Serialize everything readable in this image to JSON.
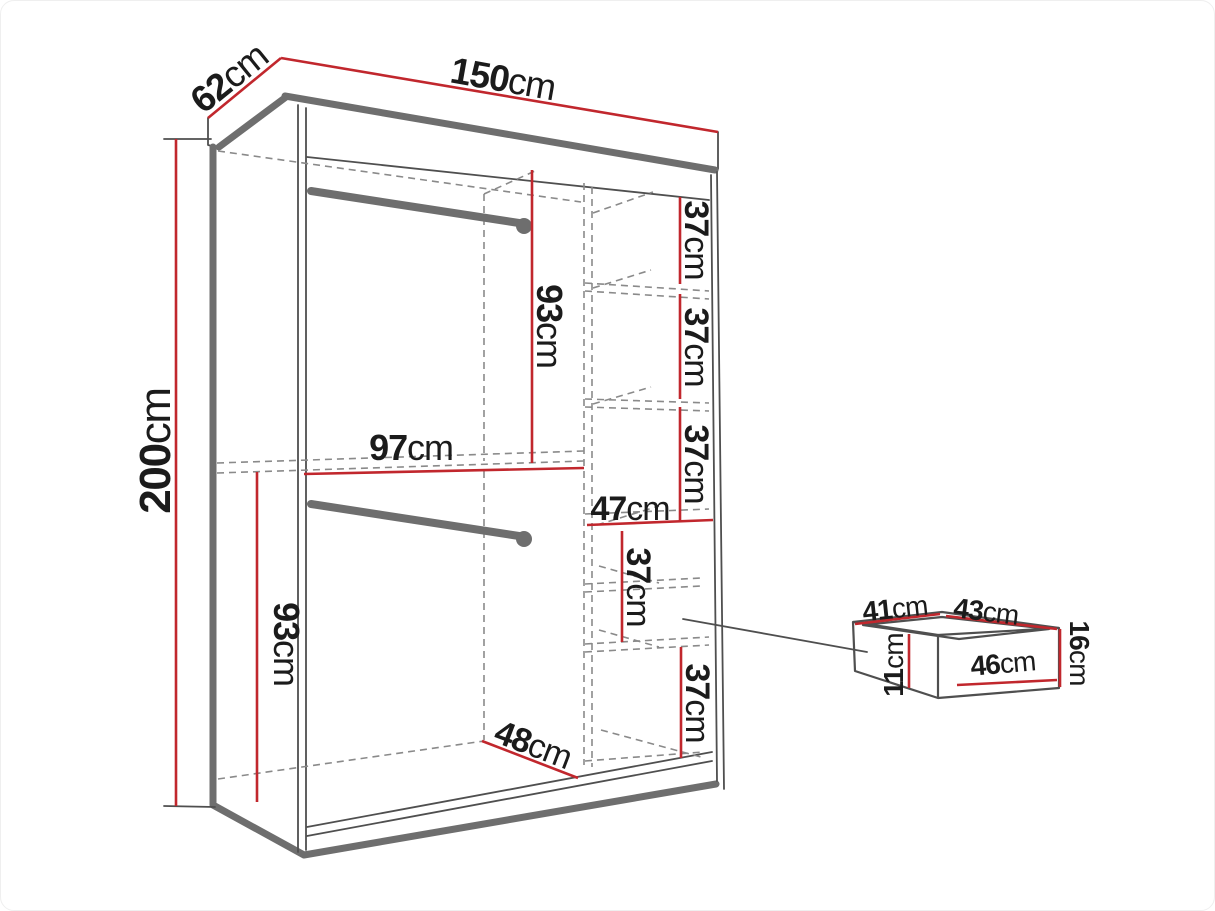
{
  "figure": {
    "type": "furniture-dimension-diagram",
    "subject": "sliding-door wardrobe with shelves, two hanging rails and drawers, plus separate drawer detail"
  },
  "colors": {
    "dimension_red": "#c1272d",
    "outline_gray": "#6e6e6e",
    "line_dark": "#4f4f4f",
    "dash_gray": "#8a8a8a",
    "text_black": "#1b1b1b",
    "background": "#ffffff"
  },
  "labels": [
    {
      "value": "62",
      "unit": "cm",
      "role": "wardrobe-depth"
    },
    {
      "value": "150",
      "unit": "cm",
      "role": "wardrobe-width"
    },
    {
      "value": "200",
      "unit": "cm",
      "role": "wardrobe-height"
    },
    {
      "value": "93",
      "unit": "cm",
      "role": "upper-hanging-section-height"
    },
    {
      "value": "97",
      "unit": "cm",
      "role": "hanging-section-width"
    },
    {
      "value": "37",
      "unit": "cm",
      "role": "shelf-gap-1"
    },
    {
      "value": "37",
      "unit": "cm",
      "role": "shelf-gap-2"
    },
    {
      "value": "37",
      "unit": "cm",
      "role": "shelf-gap-3"
    },
    {
      "value": "47",
      "unit": "cm",
      "role": "shelf-column-width"
    },
    {
      "value": "37",
      "unit": "cm",
      "role": "drawer-compartment-height"
    },
    {
      "value": "93",
      "unit": "cm",
      "role": "lower-hanging-section-height"
    },
    {
      "value": "37",
      "unit": "cm",
      "role": "bottom-compartment-height"
    },
    {
      "value": "48",
      "unit": "cm",
      "role": "interior-floor-depth"
    },
    {
      "value": "41",
      "unit": "cm",
      "role": "drawer-inner-depth"
    },
    {
      "value": "43",
      "unit": "cm",
      "role": "drawer-inner-width"
    },
    {
      "value": "16",
      "unit": "cm",
      "role": "drawer-front-height"
    },
    {
      "value": "11",
      "unit": "cm",
      "role": "drawer-inner-height"
    },
    {
      "value": "46",
      "unit": "cm",
      "role": "drawer-front-width"
    }
  ]
}
